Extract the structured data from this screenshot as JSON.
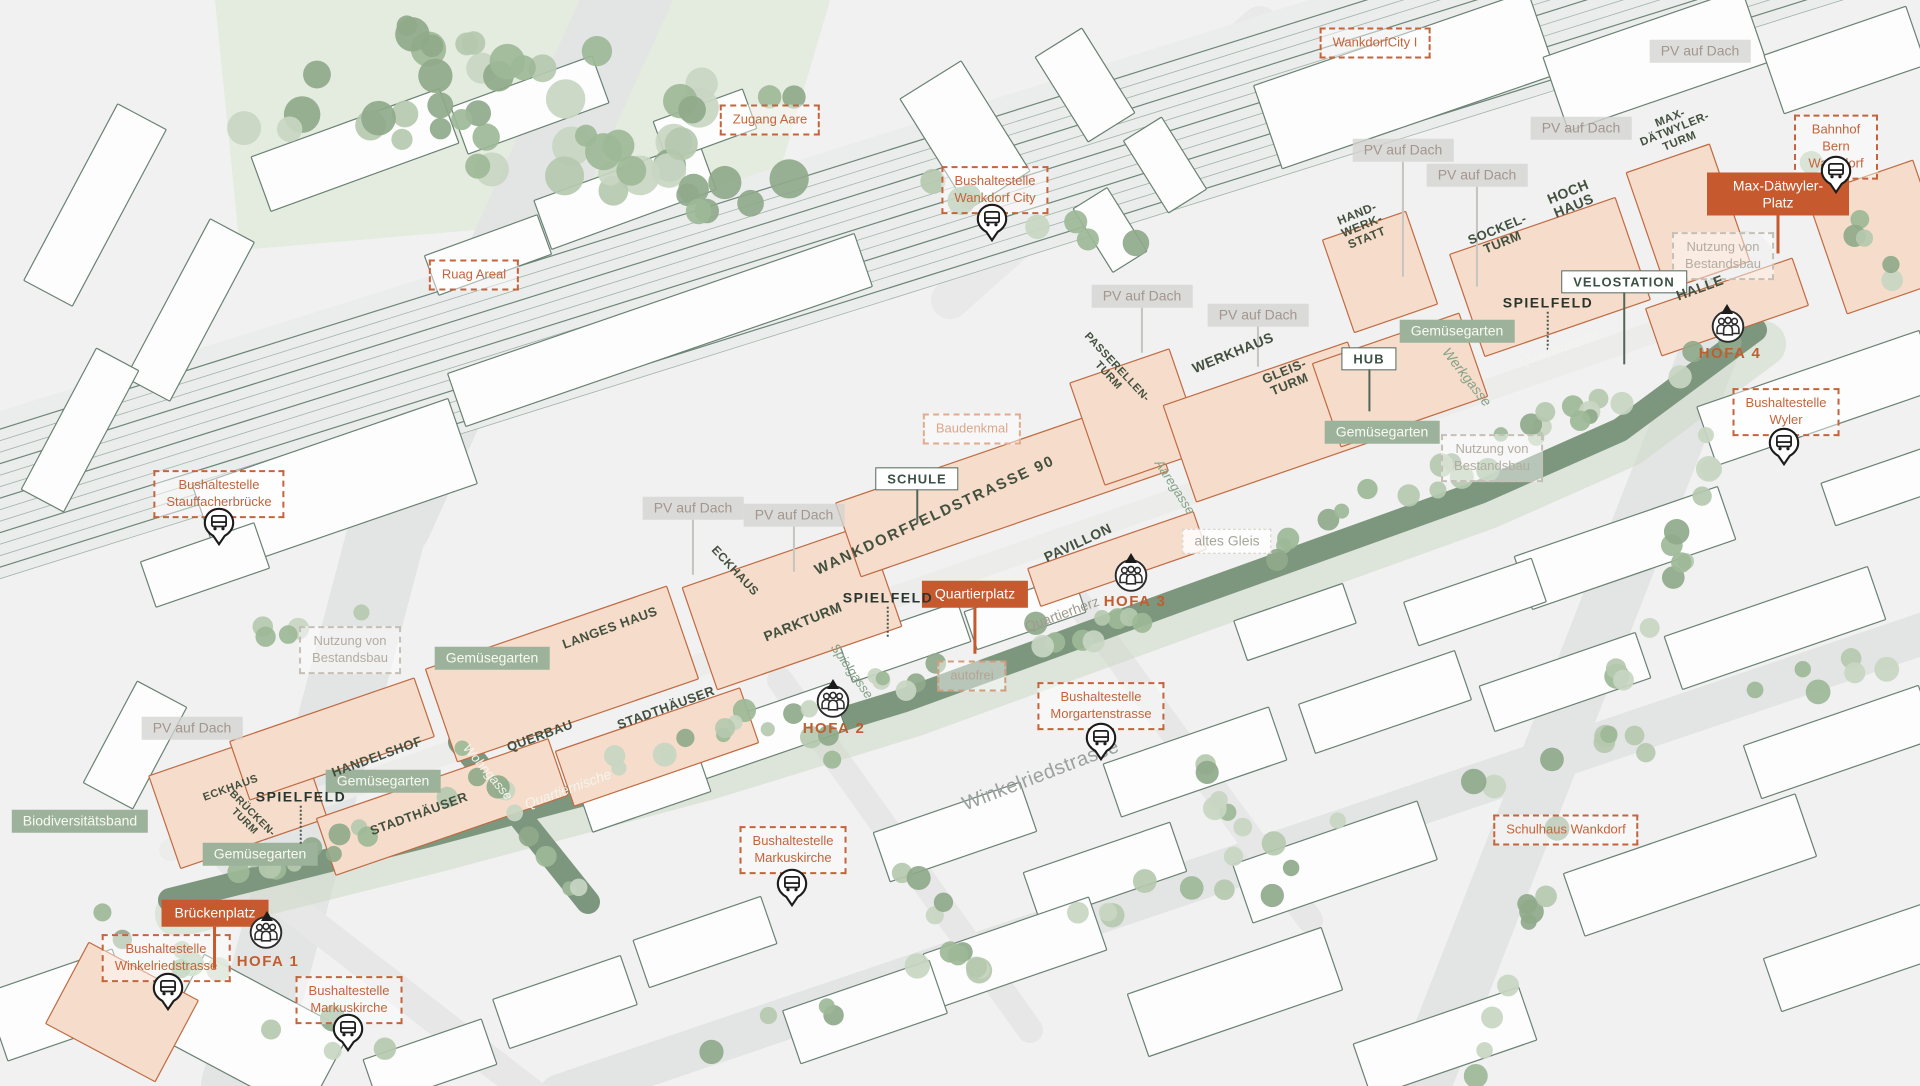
{
  "map_title": "Wankdorf quarter isometric site plan",
  "colors": {
    "accent_orange": "#c65a2e",
    "dashed_orange": "#c4643c",
    "sage_tag": "#9cb29a",
    "landscape_strip": "#7d977e",
    "roof_text": "#44503f",
    "context_outline": "#6a8173",
    "project_outline": "#c06a42"
  },
  "annotations": {
    "gray_tags": [
      {
        "text": "PV auf Dach",
        "x": 1700,
        "y": 51
      },
      {
        "text": "PV auf Dach",
        "x": 1581,
        "y": 128
      },
      {
        "text": "PV auf Dach",
        "x": 1403,
        "y": 150,
        "pole": 115
      },
      {
        "text": "PV auf Dach",
        "x": 1477,
        "y": 175,
        "pole": 100
      },
      {
        "text": "PV auf Dach",
        "x": 1142,
        "y": 296,
        "pole": 45
      },
      {
        "text": "PV auf Dach",
        "x": 1258,
        "y": 315,
        "pole": 40
      },
      {
        "text": "PV auf Dach",
        "x": 693,
        "y": 508,
        "pole": 55
      },
      {
        "text": "PV auf Dach",
        "x": 794,
        "y": 515,
        "pole": 45
      },
      {
        "text": "PV auf Dach",
        "x": 192,
        "y": 728
      },
      {
        "text": "altes Gleis",
        "x": 1227,
        "y": 541,
        "variant": "ghost"
      }
    ],
    "dashed_labels": [
      {
        "text": "WankdorfCity I",
        "x": 1375,
        "y": 43
      },
      {
        "text": "Zugang Aare",
        "x": 770,
        "y": 120
      },
      {
        "text": "Bushaltestelle\nWankdorf City",
        "x": 995,
        "y": 190
      },
      {
        "text": "Ruag Areal",
        "x": 474,
        "y": 275
      },
      {
        "text": "Bahnhof Bern\nWankdorf",
        "x": 1836,
        "y": 147
      },
      {
        "text": "Bushaltestelle\nWyler",
        "x": 1786,
        "y": 412
      },
      {
        "text": "Bushaltestelle\nStauffacherbrücke",
        "x": 219,
        "y": 494
      },
      {
        "text": "Nutzung von\nBestandsbau",
        "x": 1723,
        "y": 256,
        "variant": "gray"
      },
      {
        "text": "Nutzung von\nBestandsbau",
        "x": 1492,
        "y": 458,
        "variant": "gray"
      },
      {
        "text": "Nutzung von\nBestandsbau",
        "x": 350,
        "y": 650,
        "variant": "gray"
      },
      {
        "text": "Baudenkmal",
        "x": 972,
        "y": 429,
        "variant": "peach"
      },
      {
        "text": "autofrei",
        "x": 972,
        "y": 676,
        "variant": "muted"
      },
      {
        "text": "Bushaltestelle\nMorgartenstrasse",
        "x": 1101,
        "y": 706
      },
      {
        "text": "Bushaltestelle\nMarkuskirche",
        "x": 793,
        "y": 850
      },
      {
        "text": "Schulhaus Wankdorf",
        "x": 1566,
        "y": 830
      },
      {
        "text": "Bushaltestelle\nWinkelriedstrasse",
        "x": 166,
        "y": 958
      },
      {
        "text": "Bushaltestelle\nMarkuskirche",
        "x": 349,
        "y": 1000
      }
    ],
    "green_tags": [
      {
        "text": "Gemüsegarten",
        "x": 1457,
        "y": 331
      },
      {
        "text": "Gemüsegarten",
        "x": 1382,
        "y": 432
      },
      {
        "text": "Gemüsegarten",
        "x": 492,
        "y": 658
      },
      {
        "text": "Gemüsegarten",
        "x": 383,
        "y": 781
      },
      {
        "text": "Gemüsegarten",
        "x": 260,
        "y": 854
      },
      {
        "text": "Biodiversitätsband",
        "x": 80,
        "y": 821
      }
    ],
    "signposts": [
      {
        "text": "SCHULE",
        "x": 917,
        "y": 479,
        "pole": 34
      },
      {
        "text": "HUB",
        "x": 1369,
        "y": 359,
        "pole": 42
      },
      {
        "text": "VELOSTATION",
        "x": 1624,
        "y": 282,
        "pole": 72
      }
    ],
    "plaza_labels": [
      {
        "text": "Max-Dätwyler-Platz",
        "x": 1778,
        "y": 194,
        "pole": 38
      },
      {
        "text": "Quartierplatz",
        "x": 975,
        "y": 594,
        "pole": 46
      },
      {
        "text": "Brückenplatz",
        "x": 215,
        "y": 913,
        "pole": 42
      }
    ],
    "roof_labels": [
      {
        "text": "MAX-\nDÄTWYLER-\nTURM",
        "x": 1675,
        "y": 130,
        "rot": -22,
        "fs": 11.5
      },
      {
        "text": "HOCH\nHAUS",
        "x": 1571,
        "y": 199,
        "rot": -22,
        "fs": 14
      },
      {
        "text": "SOCKEL-\nTURM",
        "x": 1500,
        "y": 236,
        "rot": -22,
        "fs": 13
      },
      {
        "text": "HAND-\nWERK-\nSTATT",
        "x": 1362,
        "y": 226,
        "rot": -22,
        "fs": 12
      },
      {
        "text": "HALLE",
        "x": 1700,
        "y": 288,
        "rot": -20,
        "fs": 14
      },
      {
        "text": "WERKHAUS",
        "x": 1233,
        "y": 353,
        "rot": -22,
        "fs": 14
      },
      {
        "text": "GLEIS-\nTURM",
        "x": 1287,
        "y": 378,
        "rot": -22,
        "fs": 13
      },
      {
        "text": "PASSERELLEN-\nTURM",
        "x": 1112,
        "y": 372,
        "rot": 47,
        "fs": 11
      },
      {
        "text": "PAVILLON",
        "x": 1078,
        "y": 543,
        "rot": -25,
        "fs": 14
      },
      {
        "text": "WANKDORFFELDSTRASSE 90",
        "x": 935,
        "y": 516,
        "rot": -25,
        "fs": 15,
        "ls": 2
      },
      {
        "text": "ECKHAUS",
        "x": 735,
        "y": 571,
        "rot": 47,
        "fs": 12
      },
      {
        "text": "PARKTURM",
        "x": 803,
        "y": 622,
        "rot": -22,
        "fs": 14
      },
      {
        "text": "LANGES HAUS",
        "x": 610,
        "y": 628,
        "rot": -20,
        "fs": 13
      },
      {
        "text": "STADTHÄUSER",
        "x": 666,
        "y": 708,
        "rot": -20,
        "fs": 13
      },
      {
        "text": "QUERBAU",
        "x": 540,
        "y": 736,
        "rot": -20,
        "fs": 13
      },
      {
        "text": "HANDELSHOF",
        "x": 377,
        "y": 757,
        "rot": -20,
        "fs": 13
      },
      {
        "text": "STADTHÄUSER",
        "x": 419,
        "y": 814,
        "rot": -20,
        "fs": 13
      },
      {
        "text": "ECKHAUS",
        "x": 231,
        "y": 789,
        "rot": -20,
        "fs": 11
      },
      {
        "text": "BRÜCKEN-\nTURM",
        "x": 248,
        "y": 818,
        "rot": 45,
        "fs": 10.5
      }
    ],
    "field_labels": [
      {
        "text": "SPIELFELD",
        "x": 1548,
        "y": 303,
        "pole": 38
      },
      {
        "text": "SPIELFELD",
        "x": 888,
        "y": 598,
        "pole": 30
      },
      {
        "text": "SPIELFELD",
        "x": 301,
        "y": 797,
        "pole": 38
      }
    ],
    "hofa_labels": [
      {
        "text": "HOFA 1",
        "x": 268,
        "y": 962
      },
      {
        "text": "HOFA 2",
        "x": 834,
        "y": 729
      },
      {
        "text": "HOFA 3",
        "x": 1135,
        "y": 602
      },
      {
        "text": "HOFA 4",
        "x": 1730,
        "y": 354
      }
    ],
    "street_labels": [
      {
        "text": "Winkelriedstrasse",
        "x": 1041,
        "y": 776,
        "rot": -21,
        "fs": 20,
        "variant": "gray"
      },
      {
        "text": "Werkgasse",
        "x": 1467,
        "y": 377,
        "rot": 52,
        "fs": 14,
        "variant": "green"
      },
      {
        "text": "Aaregasse",
        "x": 1175,
        "y": 487,
        "rot": 57,
        "fs": 13,
        "variant": "green"
      },
      {
        "text": "Spielgasse",
        "x": 852,
        "y": 671,
        "rot": 55,
        "fs": 13,
        "variant": "green"
      },
      {
        "text": "Wohngasse",
        "x": 488,
        "y": 772,
        "rot": 50,
        "fs": 13,
        "variant": "white"
      },
      {
        "text": "Quartiernische",
        "x": 568,
        "y": 789,
        "rot": -20,
        "fs": 14,
        "variant": "white"
      },
      {
        "text": "Quartiernische",
        "x": 1560,
        "y": 348,
        "rot": -20,
        "fs": 13,
        "variant": "white"
      },
      {
        "text": "Quartierherz",
        "x": 1062,
        "y": 614,
        "rot": -20,
        "fs": 14,
        "variant": "warm"
      }
    ],
    "bus_icons": [
      {
        "x": 992,
        "y": 225
      },
      {
        "x": 1836,
        "y": 177
      },
      {
        "x": 1784,
        "y": 449
      },
      {
        "x": 219,
        "y": 529
      },
      {
        "x": 1101,
        "y": 744
      },
      {
        "x": 792,
        "y": 890
      },
      {
        "x": 168,
        "y": 994
      },
      {
        "x": 348,
        "y": 1035
      }
    ],
    "people_icons": [
      {
        "x": 266,
        "y": 935
      },
      {
        "x": 833,
        "y": 704
      },
      {
        "x": 1131,
        "y": 578
      },
      {
        "x": 1728,
        "y": 329
      }
    ],
    "entry_markers": [
      {
        "x": 267,
        "y": 916
      },
      {
        "x": 833,
        "y": 684
      },
      {
        "x": 1131,
        "y": 558
      },
      {
        "x": 1727,
        "y": 309
      }
    ]
  }
}
